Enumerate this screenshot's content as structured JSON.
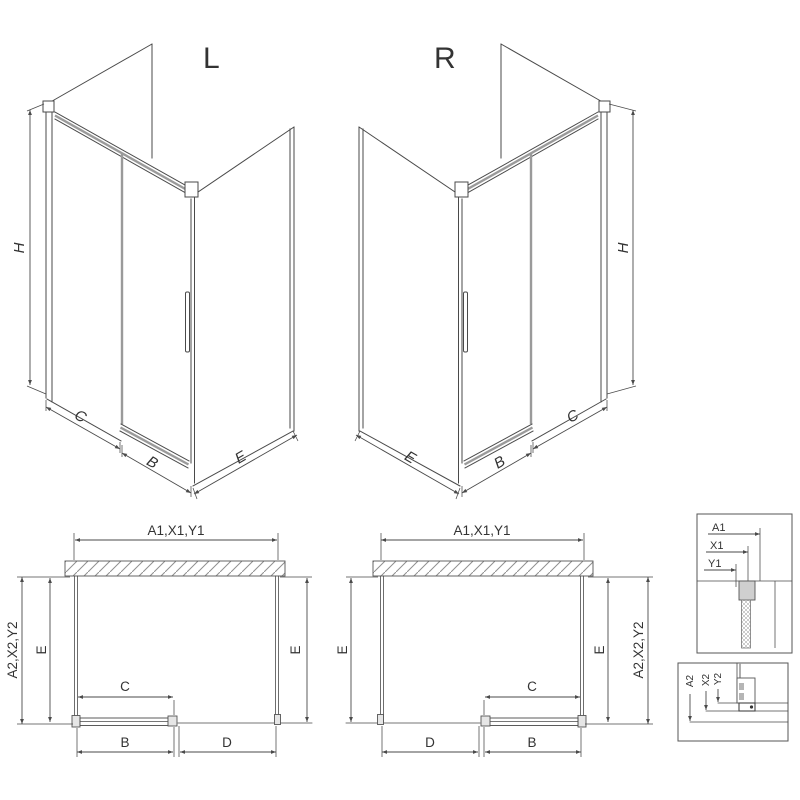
{
  "drawing": {
    "type": "shower-enclosure-technical-diagram",
    "colors": {
      "line": "#4a4a4a",
      "grey": "#9a9a9a",
      "background": "#ffffff",
      "hatch": "#8f8f8f"
    },
    "iso_left": {
      "title": "L",
      "dim_height": "H",
      "dim_fixed": "C",
      "dim_door": "B",
      "dim_side": "E"
    },
    "iso_right": {
      "title": "R",
      "dim_height": "H",
      "dim_fixed": "C",
      "dim_door": "B",
      "dim_side": "E"
    },
    "plan_left": {
      "dim_top": "A1,X1,Y1",
      "dim_left_outer": "A2,X2,Y2",
      "dim_side_left": "E",
      "dim_side_right": "E",
      "dim_door": "C",
      "dim_bottom_left": "B",
      "dim_bottom_right": "D"
    },
    "plan_right": {
      "dim_top": "A1,X1,Y1",
      "dim_right_outer": "A2,X2,Y2",
      "dim_side_left": "E",
      "dim_side_right": "E",
      "dim_door": "C",
      "dim_bottom_left": "D",
      "dim_bottom_right": "B"
    },
    "detail_top": {
      "dim_a": "A1",
      "dim_x": "X1",
      "dim_y": "Y1"
    },
    "detail_bottom": {
      "dim_a": "A2",
      "dim_x": "X2",
      "dim_y": "Y2"
    }
  }
}
